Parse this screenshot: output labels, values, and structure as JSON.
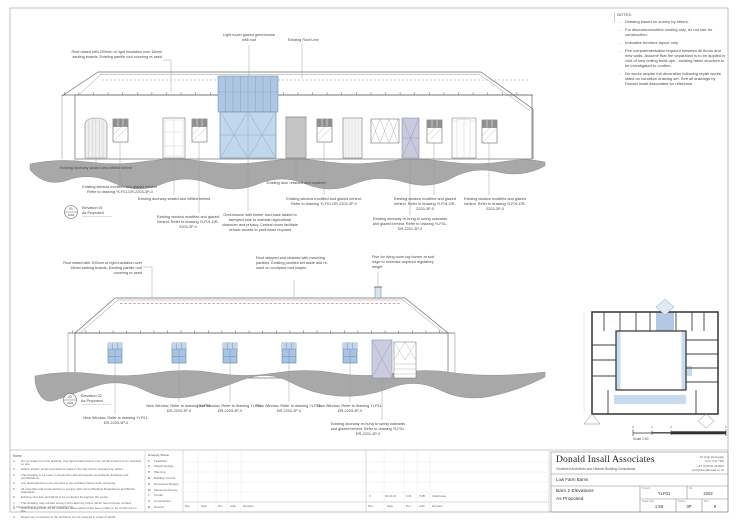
{
  "sheet_notes": {
    "title": "NOTES:",
    "items": [
      "Drawing based on survey by others.",
      "For discussion/outline costing only, do not use for construction.",
      "Indicative furniture layout only.",
      "Fire compartmentation required between all floors and new walls. Assume that fire separation is to be applied in void of new ceiling build-ups - building fabric structure to be investigated to confirm.",
      "No works require full decoration following repair works listed on condition drawing set. See all drawings by Donald Insall Associates for reference."
    ]
  },
  "el1": {
    "marker_no": "01",
    "marker_sheet": "2202",
    "marker_label1": "Elevation 01",
    "marker_label2": "As Proposed",
    "roof_label": "Roof raised with 200mm of rigid insulation over 18mm sarking boards. Existing pantile roof covering re-used",
    "greenhouse_label": "Light touch glazed greenhouse infill roof",
    "roofline_label": "Existing Roof Line",
    "ann": [
      "Existing doorway sealed and infilled behind",
      "Existing window modified and glazed behind. Refer to drawing YLF01-DR-2203-3P-0",
      "Existing doorway sealed and infilled behind",
      "Existing window modified and glazed behind. Refer to drawing YLF01-DR-2203-3P-0",
      "Greenhouse with timber clad base added to farmyard side to maintain agricultural character and privacy. Central doors facilitate vehicle access to yard when required",
      "Existing door retained and repaired",
      "Existing window modified and glazed behind. Refer to drawing YLF01-DR-2203-3P-0",
      "Existing doorway re-hung to swing outwards and glazed behind. Refer to drawing YLF01-DR-2201-3P-0",
      "Existing window modified and glazed behind. Refer to drawing YLF01-DR-2203-3P-0",
      "Existing window modified and glazed behind. Refer to drawing YLF01-DR-2203-3P-0"
    ]
  },
  "el2": {
    "marker_no": "02",
    "marker_sheet": "2202",
    "marker_label1": "Elevation 02",
    "marker_label2": "As Proposed",
    "roof_label": "Roof raised with 200mm of rigid insulation over 18mm sarking boards. Existing pantile roof covering re-used",
    "reroof_label": "Roof stripped and relaided with matching pantiles. Existing pantiles set aside and re-used on courtyard roof slopes",
    "flue_label": "Flue for living room log burner at roof ridge to minimise required regulatory height",
    "ann": [
      "New Window. Refer to drawing YLF01-DR-2203-3P-0",
      "New Window. Refer to drawing YLF01-DR-2203-3P-0",
      "New Window. Refer to drawing YLF01-DR-2203-3P-0",
      "New Window. Refer to drawing YLF01-DR-2203-3P-0",
      "New Window. Refer to drawing YLF01-DR-2203-3P-0",
      "Existing doorway re-hung to swing outwards and glazed behind. Refer to drawing YLF01-DR-2201-3P-0"
    ]
  },
  "key_plan": {
    "scale_ticks": [
      "0",
      "1",
      "2",
      "5"
    ],
    "scale_label": "Scale 1:50"
  },
  "footer": {
    "general_notes_title": "Notes:",
    "general_notes": [
      "Do not scale from this drawing. Use figured dimensions only; all dimensions to be checked on site.",
      "Where shown, levels and datums relate to the site survey prepared by others.",
      "This drawing to be read in conjunction with all relevant consultants' drawings and specifications.",
      "Any discrepancies to be reported to the architect before work proceeds.",
      "All materials and workmanship to comply with current Building Regulations and British Standards.",
      "Existing structure and fabric to be protected throughout the works.",
      "This drawing may contain survey information by others which has not been verified.",
      "Where areas could not be inspected assumptions have been made; to be confirmed on site.",
      "Report any omissions to the architect; do not proceed in areas of doubt."
    ],
    "copyright": "© 2023 DONALD INSALL ASSOCIATES LTD",
    "status_title": "Drawing Status",
    "status": [
      {
        "c": "F",
        "l": "Feasibility"
      },
      {
        "c": "S",
        "l": "Sketch Design"
      },
      {
        "c": "P",
        "l": "Planning"
      },
      {
        "c": "B",
        "l": "Building Control"
      },
      {
        "c": "D",
        "l": "Developed Design"
      },
      {
        "c": "M",
        "l": "Measured Survey"
      },
      {
        "c": "T",
        "l": "Tender"
      },
      {
        "c": "C",
        "l": "Construction"
      },
      {
        "c": "R",
        "l": "Record"
      }
    ],
    "rev_headers": [
      "Rev",
      "Date",
      "Drn",
      "Auth",
      "Revision"
    ],
    "rev_entry": [
      "0",
      "02.10.23",
      "CJS",
      "TOB",
      "Initial Issue"
    ],
    "tb": {
      "firm": "Donald Insall Associates",
      "sub": "Chartered Architects and Historic Building Consultants",
      "addr1": "10 High Petergate",
      "addr2": "York YO1 7EN",
      "addr3": "+44 (0)1904 234566",
      "addr4": "york@donaldinsall.co.uk",
      "project": "Low Farm Barns",
      "title1": "Barn 2 Elevations",
      "title2": "As Proposed",
      "f_project_l": "Project",
      "f_project_v": "YLF01",
      "f_no_l": "No.",
      "f_no_v": "2202",
      "f_scale_l": "Scale (A1)",
      "f_scale_v": "1:50",
      "f_status_l": "Status",
      "f_status_v": "3P",
      "f_rev_l": "Rev",
      "f_rev_v": "0"
    }
  },
  "colors": {
    "glazing_blue": "#aec6e2",
    "door_lilac": "#c9cadd",
    "ground_grey": "#a8a8a8",
    "existing_roofline_red": "#b5483f"
  }
}
